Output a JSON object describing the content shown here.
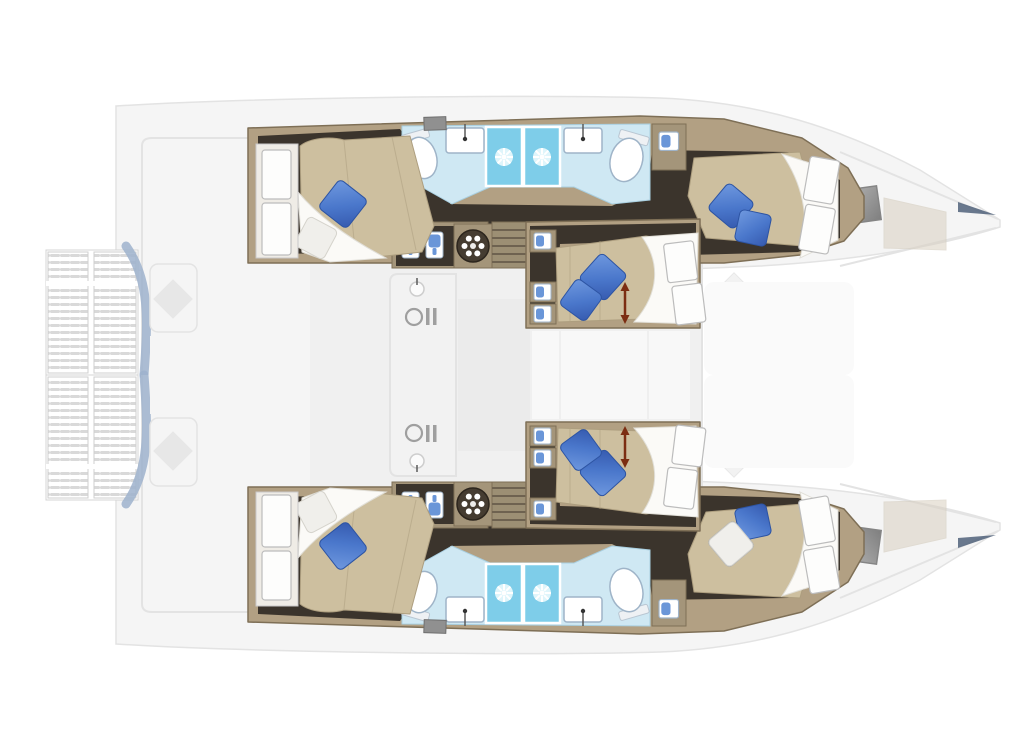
{
  "diagram": {
    "type": "catamaran-interior-floor-plan",
    "orientation": {
      "bow": "right",
      "stern": "left"
    },
    "style_note": "hull-level interior rendered in full color; deck level rendered faded/ghosted",
    "hull_top": {
      "aft_cabin": {
        "bed": "angled island double",
        "pillows": [
          "blue",
          "white"
        ],
        "wardrobe_panels": 2
      },
      "bathrooms": [
        {
          "position": "aft",
          "fixtures": [
            "toilet",
            "sink"
          ],
          "shower_stall": true
        },
        {
          "position": "forward",
          "fixtures": [
            "sink",
            "toilet"
          ],
          "shower_stall": true
        }
      ],
      "utility": {
        "washer_lockers": 2,
        "round_hatch": true,
        "stairs_to_salon": true,
        "hanging_locker": true
      },
      "forward_cabin": {
        "bed": "angled island double",
        "pillows": [
          "blue",
          "blue"
        ],
        "wardrobe_panels": 2
      }
    },
    "hull_bottom": {
      "mirror_of": "hull_top",
      "forward_cabin_pillows": [
        "blue",
        "white"
      ]
    },
    "mid_cabin_top": {
      "bed": "double with slide adjustment",
      "pillows": [
        "blue",
        "blue"
      ],
      "slide_arrow": true,
      "berth_lockers": 3,
      "door_panels": 2
    },
    "mid_cabin_bottom": {
      "mirror_of": "mid_cabin_top"
    },
    "deck_faded": {
      "stern_platform": "slatted swim platform",
      "cockpit": [
        "table with cushion",
        "bench seating"
      ],
      "salon": [
        "galley counter",
        "galley sink",
        "stove",
        "sofa",
        "saloon table",
        "lounge diamond cushions"
      ],
      "foredeck": [
        "gray hatch windows",
        "tan sun pads",
        "navy bow fittings",
        "pointed bow tips"
      ]
    },
    "icons": [
      "shower-sunburst-icon",
      "round-hatch-icon",
      "washer-locker-icon",
      "berth-locker-icon",
      "stove-icon",
      "faucet-icon",
      "slide-arrow-icon"
    ]
  },
  "colors": {
    "wall": "#b2a083",
    "wallStroke": "#7e6f56",
    "floor": "#3b342c",
    "mattress": "#cdbf9f",
    "mattressEdge": "#ad9e7f",
    "duvet": "#fbfaf7",
    "pillowBlue": "#4a77cb",
    "pillowWhite": "#f0efeb",
    "bath": "#cfe8f3",
    "bathEdge": "#a9cfe0",
    "shower": "#7ecde9",
    "fixture": "#9fb4c8",
    "cabinet": "#a4957a",
    "stairs": "#9c8f74",
    "stairsLine": "#6e6250",
    "iconDark": "#453c31",
    "arrowRed": "#7c2d12",
    "lockerBlue": "#6a96d8",
    "fadedFill": "#f5f5f5",
    "fadedStroke": "#e3e3e3",
    "curveBlue": "#9db2cd",
    "hatchGray": "#969696",
    "padTan": "#d9d0c1",
    "bowNavy": "#50617a"
  }
}
